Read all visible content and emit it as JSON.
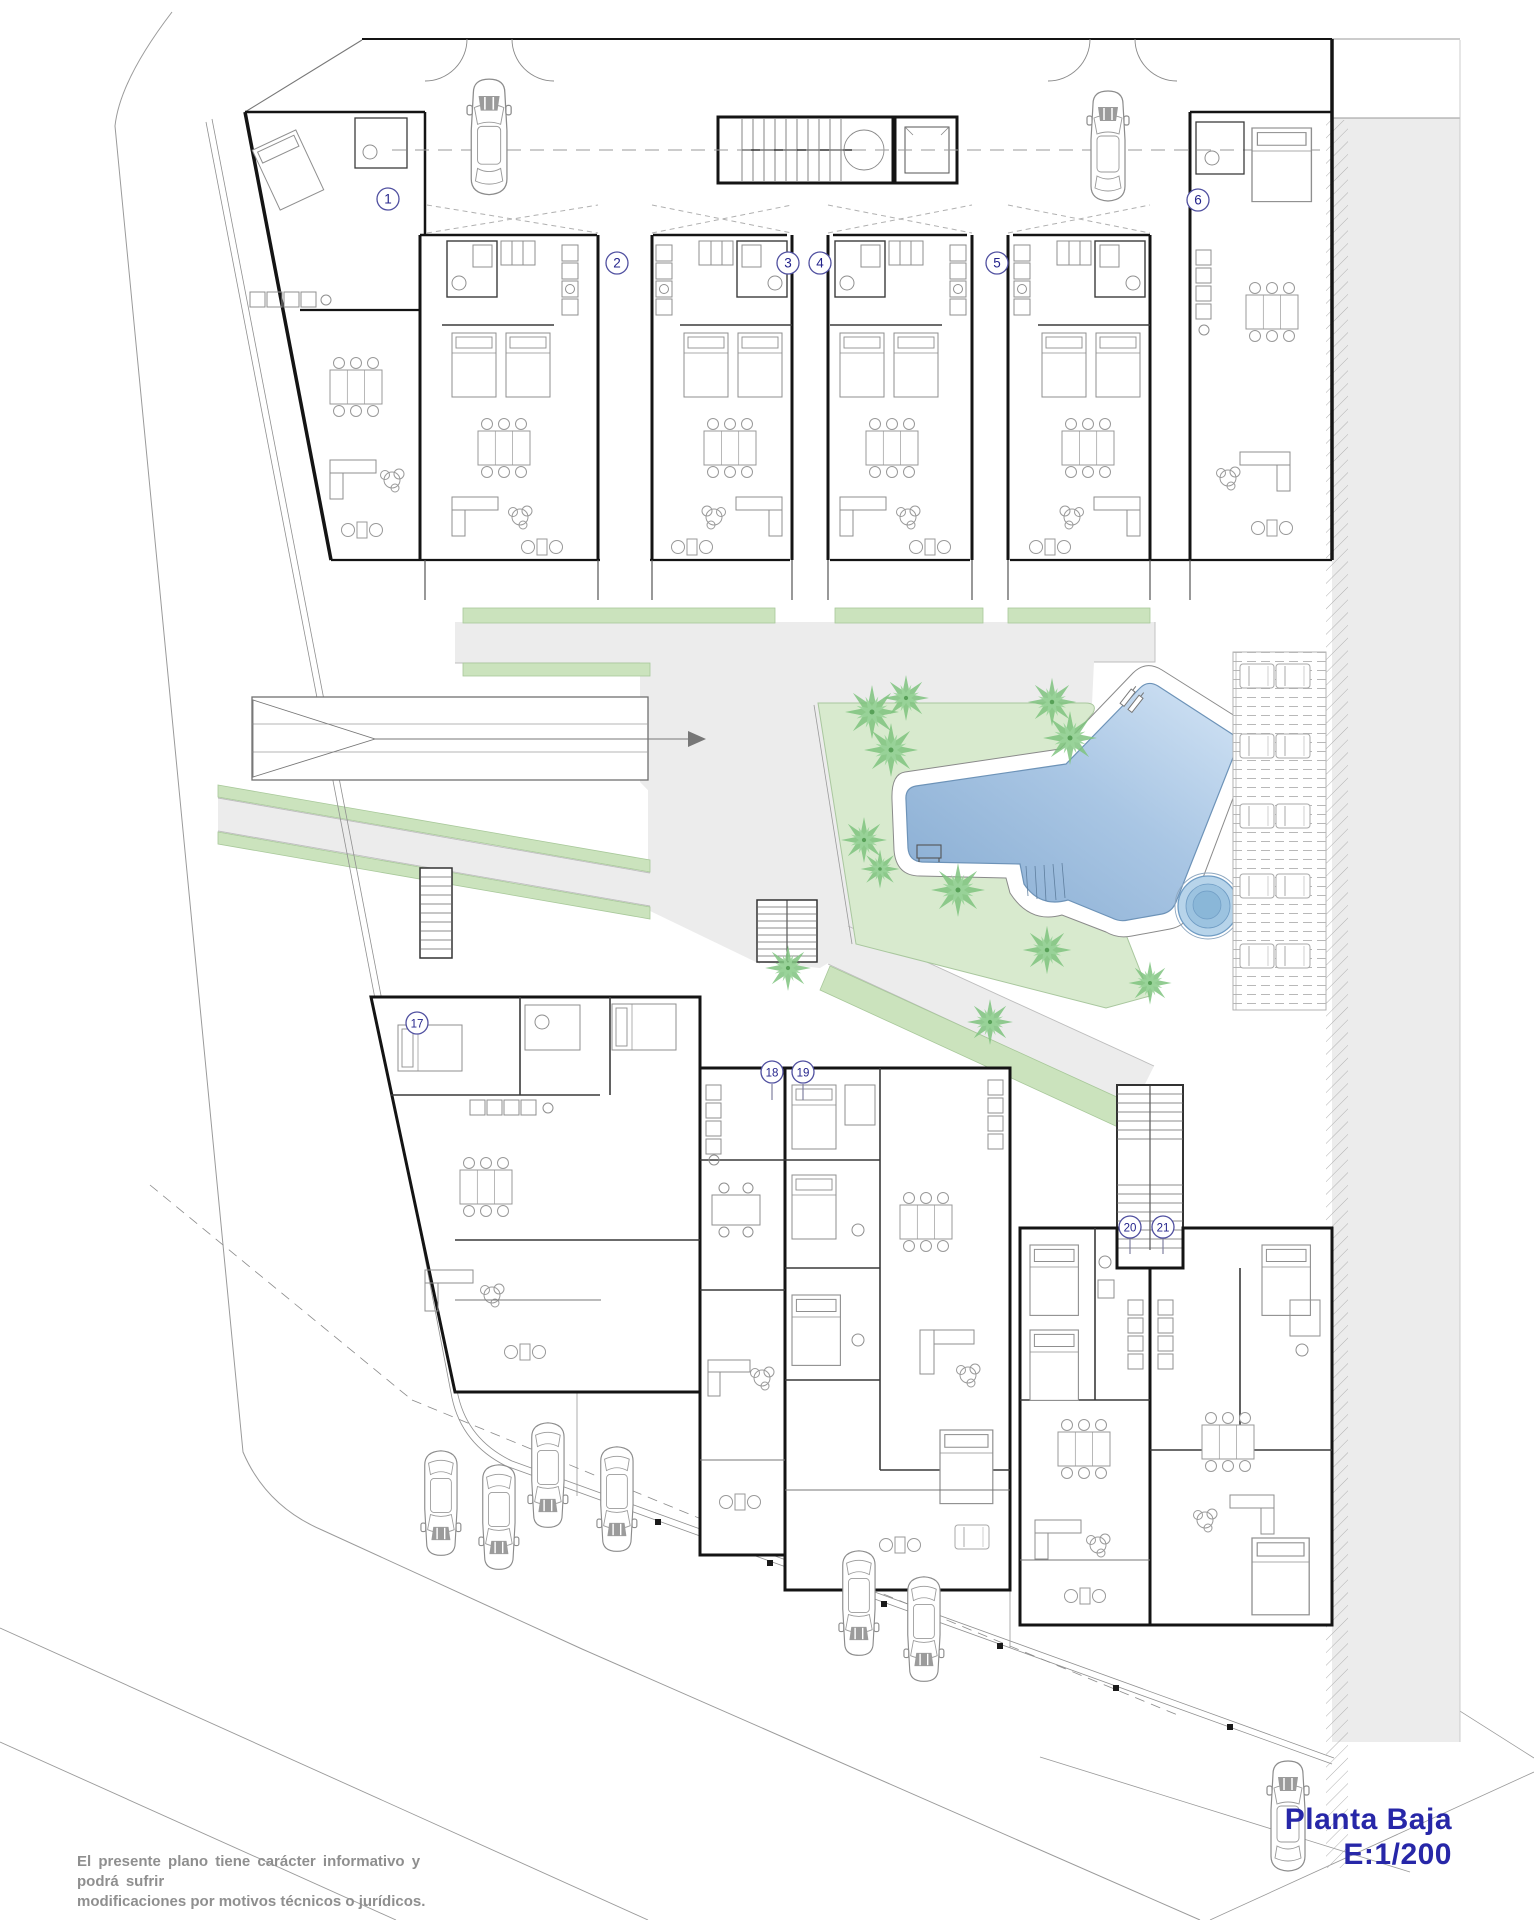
{
  "title": {
    "name": "Planta Baja",
    "scale": "E:1/200",
    "color": "#2727a8"
  },
  "disclaimer": {
    "line1": "El presente plano tiene carácter informativo y podrá sufrir",
    "line2": "modificaciones por motivos técnicos o jurídicos."
  },
  "colors": {
    "marker_stroke": "#5050a0",
    "marker_text": "#24248c",
    "lawn": "#d8eace",
    "green_strip": "#cbe3bd",
    "path_gray": "#ececec",
    "pool_dark": "#8cb1d6",
    "pool_light": "#cfe1f3",
    "spa": "#9cc3e0",
    "palm": "#7fc47f",
    "wall": "#141414"
  },
  "unit_markers": [
    {
      "label": "1",
      "x": 388,
      "y": 199
    },
    {
      "label": "2",
      "x": 617,
      "y": 263
    },
    {
      "label": "3",
      "x": 788,
      "y": 263
    },
    {
      "label": "4",
      "x": 820,
      "y": 263
    },
    {
      "label": "5",
      "x": 997,
      "y": 263
    },
    {
      "label": "6",
      "x": 1198,
      "y": 200
    },
    {
      "label": "17",
      "x": 417,
      "y": 1023
    },
    {
      "label": "18",
      "x": 772,
      "y": 1072
    },
    {
      "label": "19",
      "x": 803,
      "y": 1072
    },
    {
      "label": "20",
      "x": 1130,
      "y": 1227
    },
    {
      "label": "21",
      "x": 1163,
      "y": 1227
    }
  ],
  "palms": [
    {
      "x": 872,
      "y": 712,
      "s": 1.0
    },
    {
      "x": 906,
      "y": 698,
      "s": 0.85
    },
    {
      "x": 891,
      "y": 750,
      "s": 1.0
    },
    {
      "x": 1052,
      "y": 702,
      "s": 0.9
    },
    {
      "x": 1070,
      "y": 738,
      "s": 1.0
    },
    {
      "x": 864,
      "y": 840,
      "s": 0.85
    },
    {
      "x": 880,
      "y": 869,
      "s": 0.72
    },
    {
      "x": 958,
      "y": 890,
      "s": 1.0
    },
    {
      "x": 1047,
      "y": 950,
      "s": 0.9
    },
    {
      "x": 1150,
      "y": 983,
      "s": 0.8
    },
    {
      "x": 788,
      "y": 968,
      "s": 0.85
    },
    {
      "x": 990,
      "y": 1022,
      "s": 0.85
    }
  ],
  "cars": [
    {
      "x": 466,
      "y": 76,
      "s": 1.05,
      "t": "up"
    },
    {
      "x": 1086,
      "y": 88,
      "s": 1.0,
      "t": "up"
    },
    {
      "x": 420,
      "y": 1448,
      "s": 0.95,
      "t": "down"
    },
    {
      "x": 478,
      "y": 1462,
      "s": 0.95,
      "t": "down"
    },
    {
      "x": 527,
      "y": 1420,
      "s": 0.95,
      "t": "down"
    },
    {
      "x": 596,
      "y": 1444,
      "s": 0.95,
      "t": "down"
    },
    {
      "x": 838,
      "y": 1548,
      "s": 0.95,
      "t": "down"
    },
    {
      "x": 903,
      "y": 1574,
      "s": 0.95,
      "t": "down"
    },
    {
      "x": 1266,
      "y": 1758,
      "s": 1.0,
      "t": "up"
    }
  ],
  "loungers": [
    {
      "x": 1240,
      "y": 664
    },
    {
      "x": 1276,
      "y": 664
    },
    {
      "x": 1240,
      "y": 734
    },
    {
      "x": 1276,
      "y": 734
    },
    {
      "x": 1240,
      "y": 804
    },
    {
      "x": 1276,
      "y": 804
    },
    {
      "x": 1240,
      "y": 874
    },
    {
      "x": 1276,
      "y": 874
    },
    {
      "x": 1240,
      "y": 944
    },
    {
      "x": 1276,
      "y": 944
    }
  ]
}
